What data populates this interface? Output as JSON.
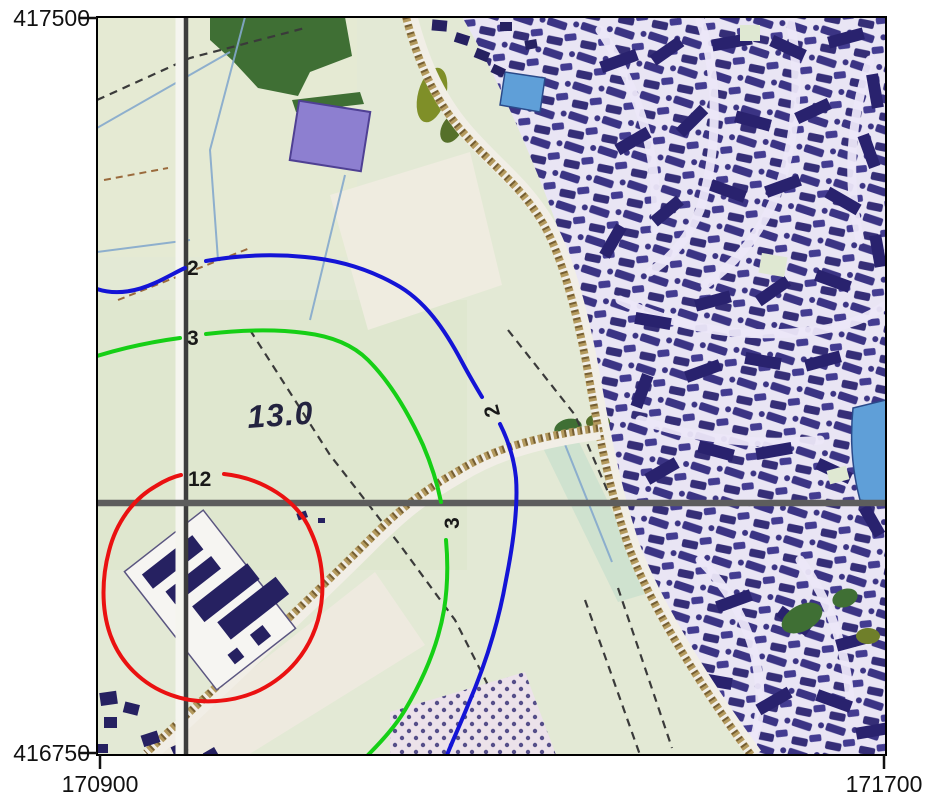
{
  "map": {
    "axis": {
      "y_top_label": "417500",
      "y_bottom_label": "416750",
      "x_left_label": "170900",
      "x_right_label": "171700"
    },
    "contour_labels": {
      "blue": {
        "value": "2",
        "color": "#1414d6"
      },
      "green": {
        "value": "3",
        "color": "#16cf16"
      },
      "red": {
        "value": "12",
        "color": "#ea1111"
      }
    },
    "spot_elevation": "13.0",
    "colors": {
      "field": "#e3e9d5",
      "urban_background": "#e9e5f4",
      "building": "#29226e",
      "road_fill": "#b49a5e",
      "water": "#5f9fd8",
      "grid_line": "#3d3d3d",
      "woodland": "#3f6f34",
      "purple_parcel": "#8d7fd0"
    }
  }
}
